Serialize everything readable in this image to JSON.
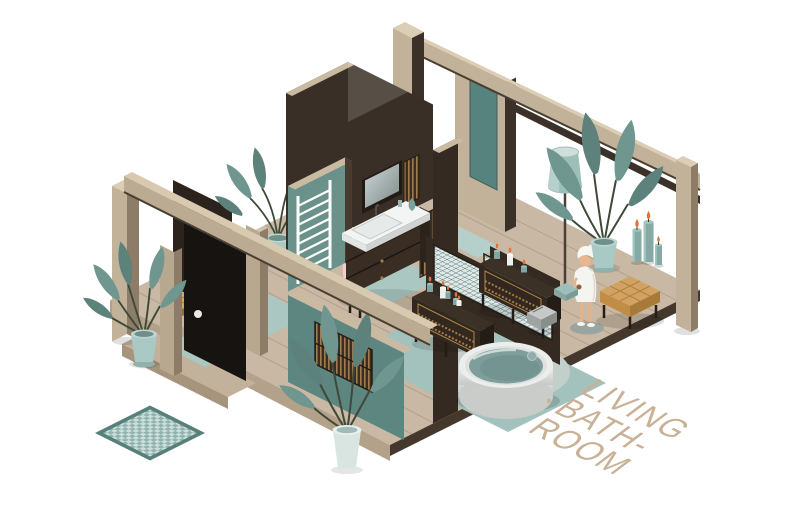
{
  "scene": {
    "caption": {
      "line1": "LIVING",
      "line2": "BATH-",
      "line3": "ROOM"
    },
    "palette": {
      "background": "#ffffff",
      "floor_wood": "#c9b8a3",
      "floor_plank_line": "#b4a38d",
      "floor_side_left": "#b3a18a",
      "floor_side_right": "#44382c",
      "beige_wood": "#c3b29a",
      "beige_cap": "#dccdb5",
      "taupe_side": "#8d7c68",
      "dark_wall": "#3a2f26",
      "darker_wall": "#2c231c",
      "black_door": "#161310",
      "teal_wall": "#6b918b",
      "teal_exterior_wall": "#5d8680",
      "teal_panel": "#56837e",
      "teal_path": "#aac7c2",
      "teal_mat": "#a3c2bd",
      "teal_pot": "#a9c9c4",
      "plant_leaf": "#6f968f",
      "plant_leaf_dark": "#5d827c",
      "pink_towel": "#f3cdc9",
      "water": "#7d9e9a",
      "ottoman_tan": "#d2a263",
      "candle_teal": "#85aaa5",
      "flame_orange": "#e0733a",
      "ornament_gold": "#b08648",
      "caption": "#c9b196"
    },
    "objects": [
      "wood platform floor",
      "checkered door mat",
      "black entry door",
      "entry bench",
      "white ladder towel rack",
      "pink hand towel",
      "wall mirror",
      "vanity with washbasin",
      "wooden slat wall panels",
      "lattice partition screen",
      "dark console tables",
      "lit candles",
      "round soaking tub",
      "metal step stool",
      "woman wrapped in bath towel",
      "tufted ottoman",
      "floor lamp",
      "potted plants",
      "pillar candles",
      "timber wall frames",
      "teal accent walls",
      "teal floor mats"
    ]
  }
}
